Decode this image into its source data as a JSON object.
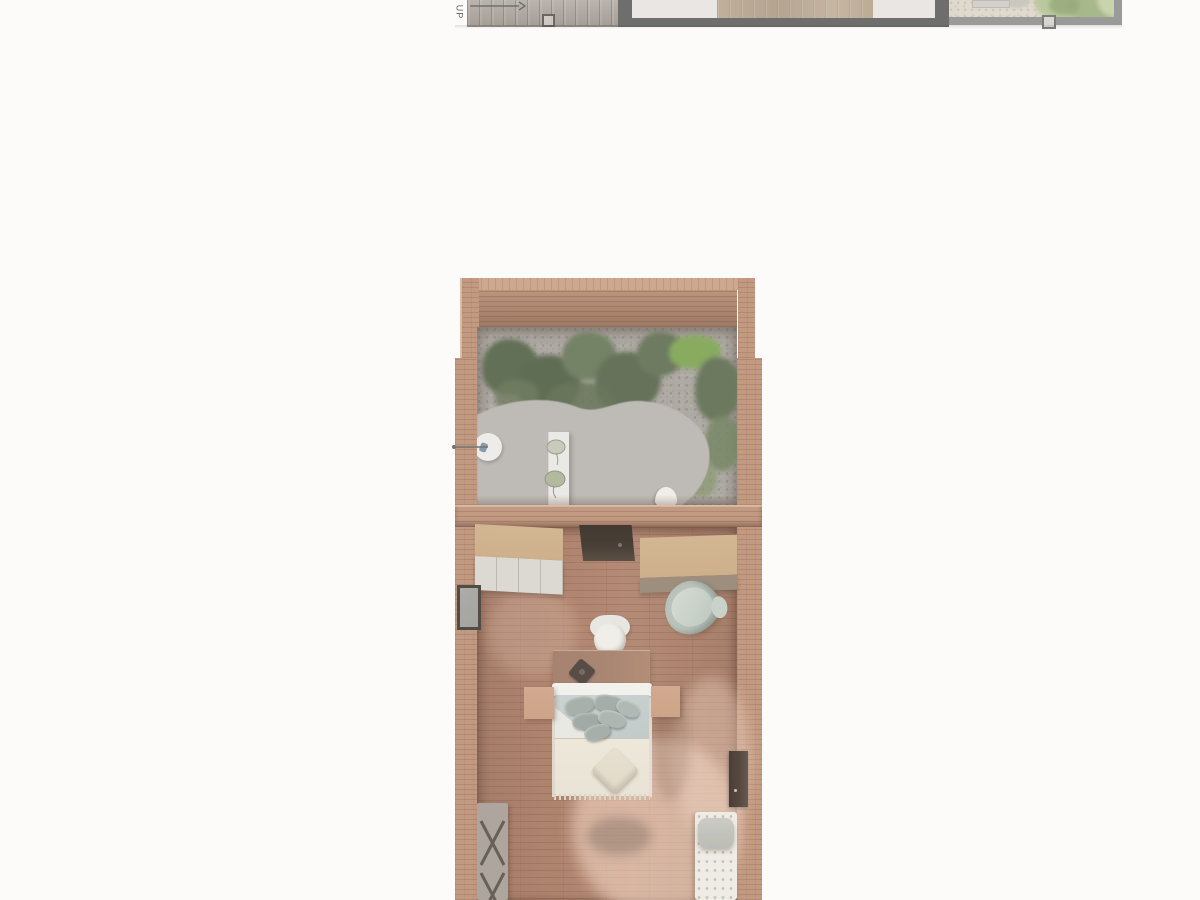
{
  "title": "Architectural floor plan render",
  "top_plan": {
    "up_label": "UP",
    "elements": [
      "stair-deck",
      "up-direction-arrow",
      "door-jamb-marker",
      "dark-wall",
      "interior-light-floor",
      "interior-wood-floor",
      "grey-wall",
      "patio-gravel",
      "tree-canopy",
      "paver",
      "window-jamb-marker"
    ]
  },
  "main_plan": {
    "rooms": [
      {
        "name": "courtyard-garden",
        "elements": [
          "wood-walls",
          "gravel-ground",
          "planting-shrubs",
          "curved-concrete-path",
          "outdoor-shower",
          "garden-bench",
          "potted-plants",
          "stool"
        ]
      },
      {
        "name": "bedroom",
        "elements": [
          "wood-plank-floor",
          "wardrobe-left",
          "wall-niche",
          "credenza-right",
          "armchair",
          "desk",
          "desk-chair",
          "table-lamp",
          "double-bed",
          "pillows",
          "throw-cushion",
          "nightstand-left",
          "nightstand-right",
          "side-window",
          "luggage-rack",
          "chaise-lounge",
          "door-panel"
        ]
      }
    ]
  },
  "colors": {
    "bg": "#fcfbfa",
    "stair": "#a9a199",
    "dark-wall": "#5e5e5c",
    "grey-wall": "#8f8f8d",
    "light-floor": "#e8e4e0",
    "strip-wood": "#b5a28b",
    "deck-gravel": "#ddd5c8",
    "wall-wood": "#bc8e73",
    "wall-cap": "#c99f82",
    "wall-face": "#aa7c61",
    "gravel": "#a5a19a",
    "path": "#b7b4af",
    "shrub-dark": "#516044",
    "shrub-mid": "#657455",
    "shrub-light": "#7d8d60",
    "shrub-bright": "#7ca24f",
    "floor-wood": "#a6775f",
    "tan-top": "#c9a87f",
    "drawer-front": "#d8d5ce",
    "niche-dark": "#352b21",
    "sage": "#b2bdb4",
    "duvet": "#c6cfce",
    "blanket": "#e6e0d1",
    "pillow": "#9fa8a3",
    "cushion": "#ddd6c3",
    "nightstand": "#c89a7b",
    "desk": "#a07a64",
    "rack": "#a49b93",
    "rack-strap": "#554f49",
    "chaise": "#edeae2",
    "bolster": "#b5b5ae",
    "door-dark": "#43352b",
    "window-frame": "#3f3831",
    "glass": "#999995",
    "shower-blue": "#7a90a6",
    "tree-green": "#a9bc8c"
  }
}
